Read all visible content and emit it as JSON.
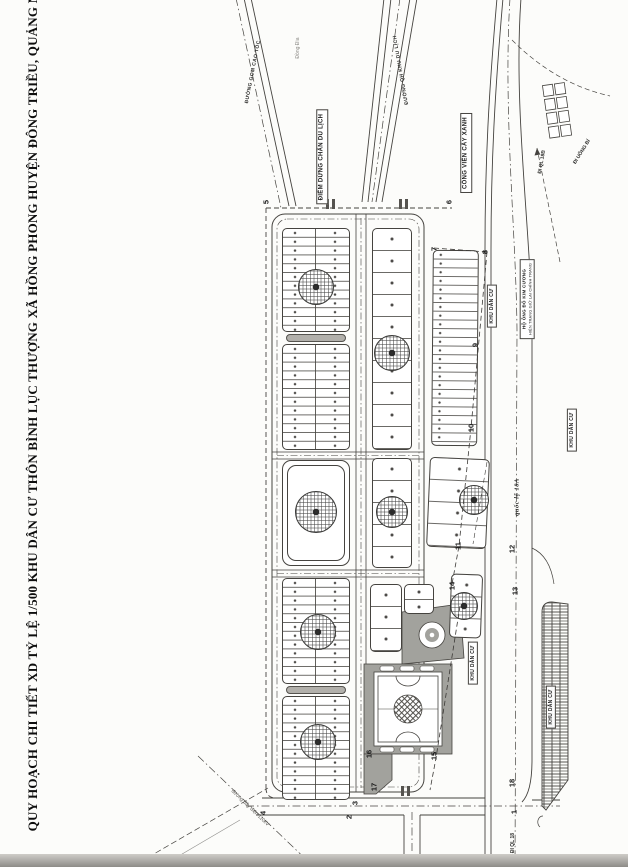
{
  "title": "QUY HOẠCH CHI TIẾT XD  TỶ LỆ 1/500 KHU DÂN CƯ THÔN BÌNH LỤC THƯỢNG XÃ HỒNG PHONG HUYỆN ĐÔNG TRIỀU, QUẢNG NINH",
  "plan": {
    "place_name": "Đồng Đìa",
    "roads": {
      "left_road": "ĐƯỜNG GOM CAO TỐC",
      "right_road": "ĐƯỜNG QH KHU DU LỊCH",
      "highway": "quốc lộ 18A",
      "dir_ql18b": "ĐI QL 18B",
      "dir_uong_bi": "ĐI UÔNG BÍ",
      "dir_ql18": "ĐI QL 18",
      "power_line": "đường dây điện 110kV"
    },
    "boxes": {
      "rest_stop": "ĐIỂM DỪNG CHÂN DU LỊCH",
      "park": "CÔNG VIÊN CÂY XANH",
      "residential": "KHU DÂN CƯ",
      "household_line1": "HỘ ÔNG ĐỖ KIM CƯƠNG",
      "household_line2": "HIỆN TRẠNG GIỮ LẠI CHỈNH TRANG"
    },
    "markers": [
      "1",
      "2",
      "3",
      "4",
      "5",
      "6",
      "7",
      "8",
      "9",
      "10",
      "11",
      "12",
      "13",
      "14",
      "15",
      "16",
      "17",
      "18"
    ]
  }
}
